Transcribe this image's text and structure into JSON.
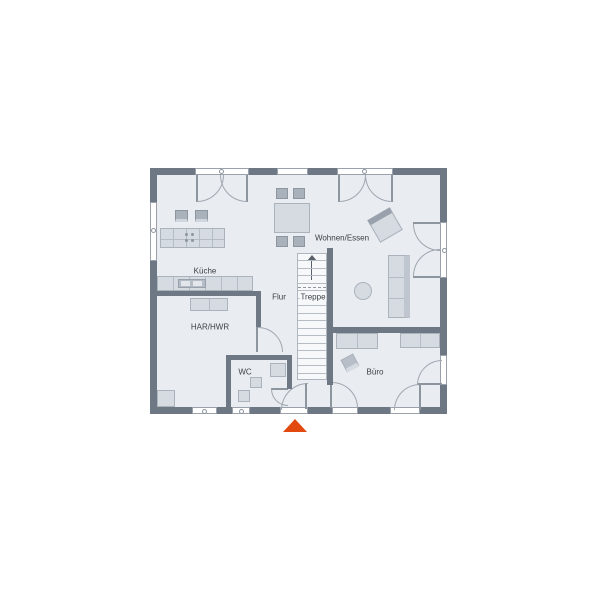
{
  "floorplan": {
    "rooms": [
      {
        "label": "Küche"
      },
      {
        "label": "Wohnen/Essen"
      },
      {
        "label": "Flur"
      },
      {
        "label": "Treppe"
      },
      {
        "label": "HAR/HWR"
      },
      {
        "label": "WC"
      },
      {
        "label": "Büro"
      }
    ],
    "colors": {
      "wall": "#6e7884",
      "floor": "#e9ecf1",
      "furniture": "#d6dbe2",
      "furniture_dark": "#a9b1bb",
      "stairs": "#f7f8fa",
      "entrance_marker": "#e2490f",
      "background": "#ffffff"
    },
    "markers": {
      "entrance_triangle": "triangle-up"
    }
  }
}
